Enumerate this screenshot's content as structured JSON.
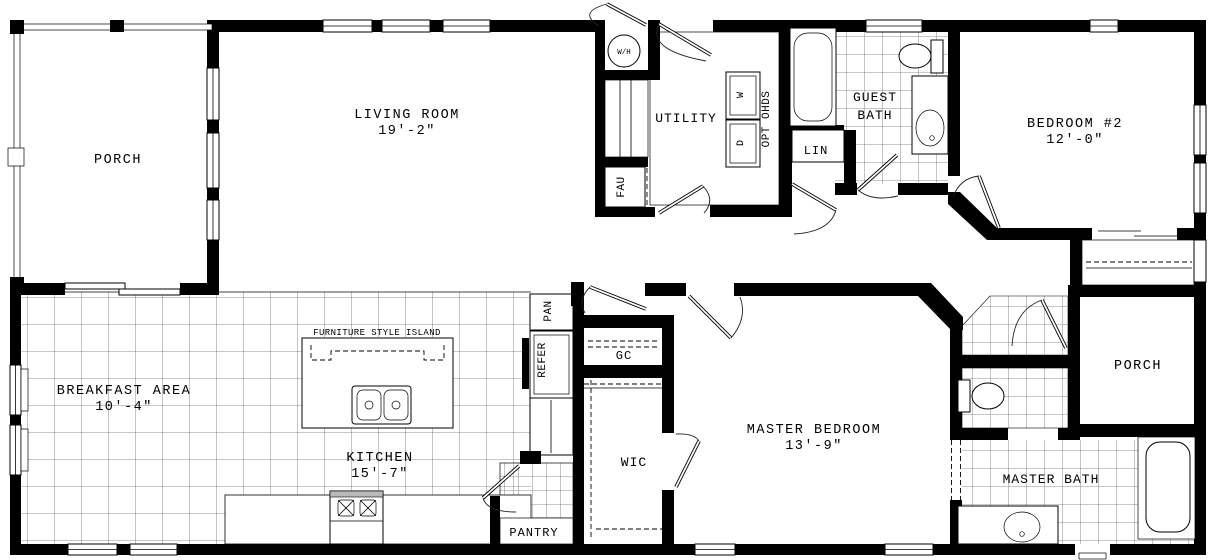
{
  "rooms": {
    "porch_left": {
      "label": "PORCH"
    },
    "living_room": {
      "label": "LIVING ROOM",
      "dim": "19'-2\""
    },
    "utility": {
      "label": "UTILITY"
    },
    "guest_bath": {
      "line1": "GUEST",
      "line2": "BATH"
    },
    "bedroom_2": {
      "label": "BEDROOM #2",
      "dim": "12'-0\""
    },
    "lin_closet": {
      "label": "LIN"
    },
    "breakfast_area": {
      "label": "BREAKFAST AREA",
      "dim": "10'-4\""
    },
    "kitchen": {
      "label": "KITCHEN",
      "dim": "15'-7\""
    },
    "pantry": {
      "label": "PANTRY"
    },
    "gc_closet": {
      "label": "GC"
    },
    "wic_closet": {
      "label": "WIC"
    },
    "master_bedroom": {
      "label": "MASTER BEDROOM",
      "dim": "13'-9\""
    },
    "porch_right": {
      "label": "PORCH"
    },
    "master_bath": {
      "label": "MASTER BATH"
    }
  },
  "fixtures": {
    "water_heater": "W/H",
    "washer": "W",
    "dryer": "D",
    "opt_overhead_doors": "OPT OHDS",
    "fau": "FAU",
    "pantry_cabinet": "PAN",
    "refrigerator": "REFER",
    "island": "FURNITURE STYLE ISLAND"
  },
  "colors": {
    "walls": "#000000",
    "tile_lines": "#6b6b6b",
    "background": "#ffffff",
    "range_top": "#b9b9b9"
  }
}
